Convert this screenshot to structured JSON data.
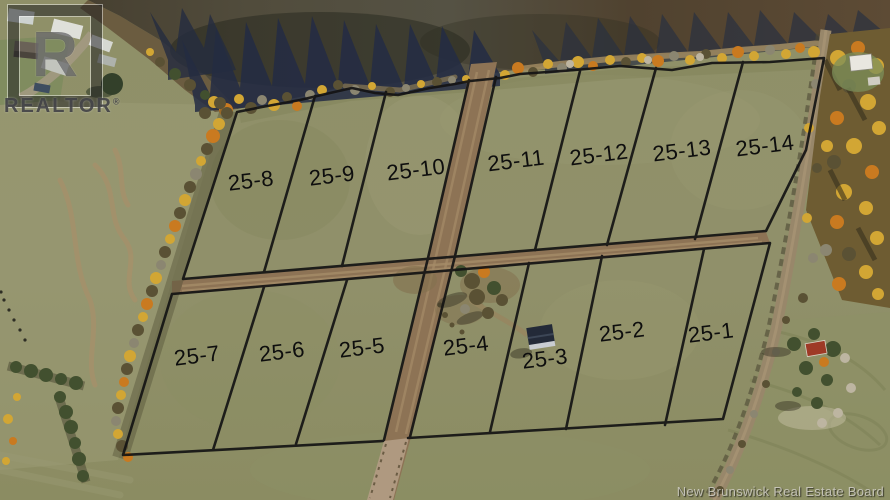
{
  "branding": {
    "logo_letter": "R",
    "logo_text": "REALTOR",
    "registered": "®"
  },
  "watermark": "New Brunswick Real Estate Board",
  "lots": {
    "prefix": "25",
    "top_row": [
      "25-8",
      "25-9",
      "25-10",
      "25-11",
      "25-12",
      "25-13",
      "25-14"
    ],
    "bottom_row": [
      "25-7",
      "25-6",
      "25-5",
      "25-4",
      "25-3",
      "25-2",
      "25-1"
    ]
  },
  "palette": {
    "lot_line": "#141414",
    "label_text": "#0e0e0e",
    "water_dark": "#514c3c",
    "field_green": "#8e9066",
    "dirt_road": "#8d7355",
    "autumn_yellow": "#d2a634",
    "autumn_orange": "#c97a20"
  }
}
